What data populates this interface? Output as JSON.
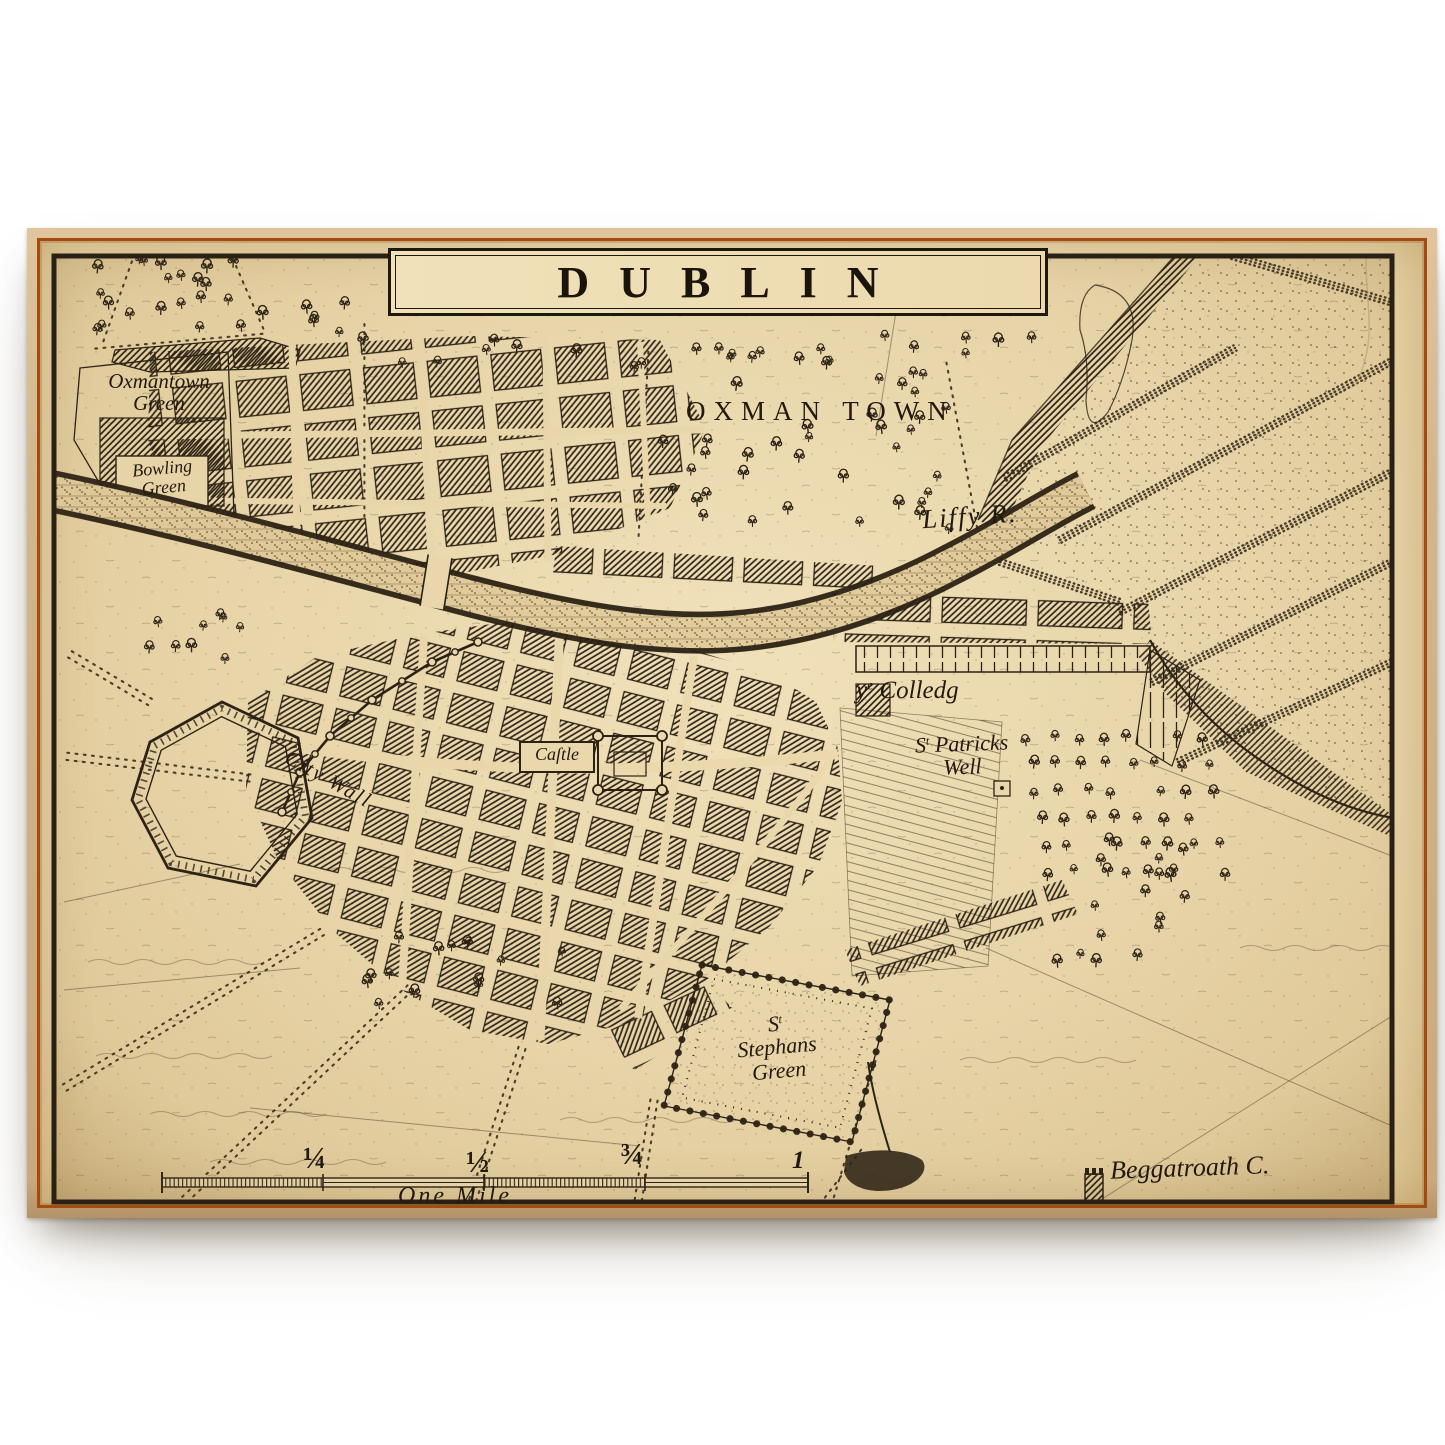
{
  "print": {
    "title": "DUBLIN",
    "labels": {
      "oxmantown_green_1": "Oxmantown",
      "oxmantown_green_2": "Green",
      "bowling_green_1": "Bowling",
      "bowling_green_2": "Green",
      "district_oxmantown": "OXMAN TOWN",
      "liffy": "Liffy R.",
      "city_wall": "City Wall",
      "castle": "Caſtle",
      "college_y": "y",
      "college_e": "e",
      "college_word": "Colledg",
      "st_s": "S",
      "st_t": "t",
      "patricks_word": "Patricks",
      "patricks_well": "Well",
      "stephans_word": "Stephans",
      "stephans_green": "Green",
      "beggatroath": "Beggatroath C.",
      "scale_q1": "¼",
      "scale_q2": "½",
      "scale_q3": "¾",
      "scale_q4": "1",
      "scale_caption": "One Mile"
    },
    "colors": {
      "paper": "#ecd9ad",
      "paper_deep": "#e3cd9c",
      "ink": "#2a2114",
      "frame": "#d2b68c",
      "pinstripe": "#a34c12"
    }
  }
}
